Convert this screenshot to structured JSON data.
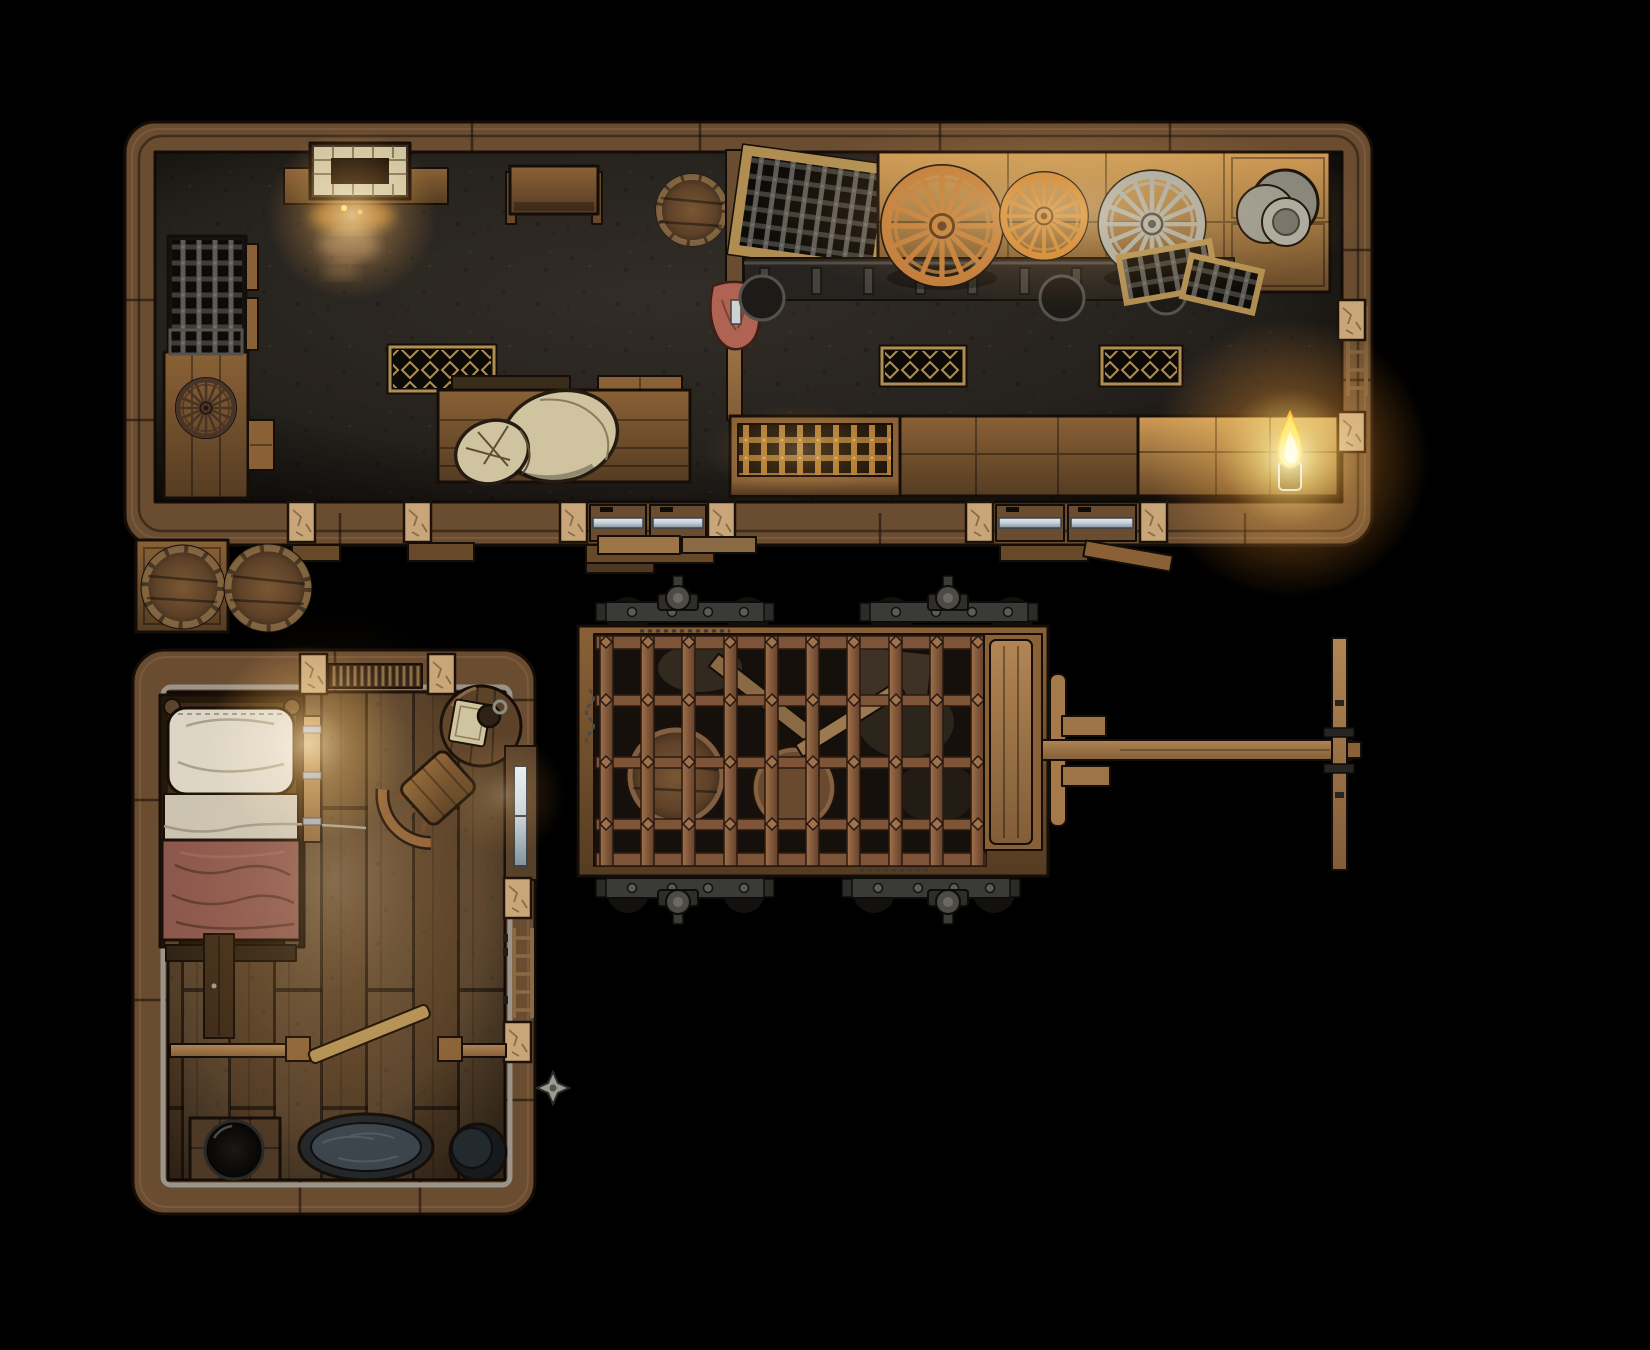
{
  "scene": {
    "title": "Wheelwright's workshop — top-down fantasy battle map, night interior lit by forge and oil lamps",
    "view": "top-down",
    "grid_visible": false
  },
  "palette": {
    "bg": "#000000",
    "wall": "#6a4c30",
    "wall_lt": "#876344",
    "outline": "#150d07",
    "floor": "#2e2a25",
    "plank": "#5d442b",
    "bench_lit": "#cf9a55",
    "bench_mid": "#8a6136",
    "bench_dark": "#674828",
    "metal": "#3e3d39",
    "metal_lt": "#5d5b54",
    "rust": "#7e5438",
    "rust_lt": "#a0714a",
    "copper": "#c07a3a",
    "bronze": "#cf8434",
    "steel": "#a8a89d",
    "stone": "#c9a67a",
    "grate_gold": "#b08e52",
    "fire": "#ffd24d",
    "fire_core": "#fff3c4",
    "ember": "#ff9a2e",
    "linen": "#dcd5c5",
    "sheet": "#cac2b0",
    "blanket": "#8a554c",
    "water": "#3c454c",
    "glass": "#c3ced6",
    "cloth": "#b06352",
    "sack": "#cfc3a0",
    "darkwood": "#4a3426"
  },
  "map_objects": {
    "workshop": {
      "label": "Workshop hall",
      "features": [
        "brick forge with glowing embers",
        "iron mesh storage rack",
        "side workbench with spare dark wheel",
        "small work table",
        "water barrel",
        "support post with hanging red apron",
        "tilted iron grate in wooden frame",
        "long lit workbench holding copper, bronze and steel wagon wheels",
        "stack of metal dishes",
        "leaning mesh grates",
        "three diamond-mesh floor grates",
        "assembly table with burlap sack",
        "grated warm bench",
        "crate benches",
        "burning oil lamp",
        "wall ladder",
        "two sliding doors with steel pulls",
        "stone door jambs and entry steps"
      ]
    },
    "bedroom": {
      "label": "Living quarters",
      "features": [
        "single bed with white pillow, folded sheet, red blanket",
        "leaning iron-fitted board",
        "round side table with trencher and tankard",
        "curved-back chair",
        "firewood shelf on wall",
        "glazed side door",
        "wall ladder",
        "narrow cupboard",
        "half-wall railing with fallen plank",
        "oval washtub with water",
        "round basin",
        "low table with iron pot",
        "stone wall pillars",
        "exterior metal sconce"
      ]
    },
    "exterior": {
      "label": "Yard",
      "features": [
        "two barrels on a crate",
        "loose planks",
        "entry steps",
        "cage wagon"
      ]
    },
    "cage_wagon": {
      "label": "Prison cage wagon",
      "features": [
        "four iron axles with hub caps",
        "riveted rusty iron cage",
        "barrels, boards and sacks inside",
        "driver platform",
        "long tow shaft",
        "T-crossbar handle",
        "hanging chains"
      ]
    }
  }
}
